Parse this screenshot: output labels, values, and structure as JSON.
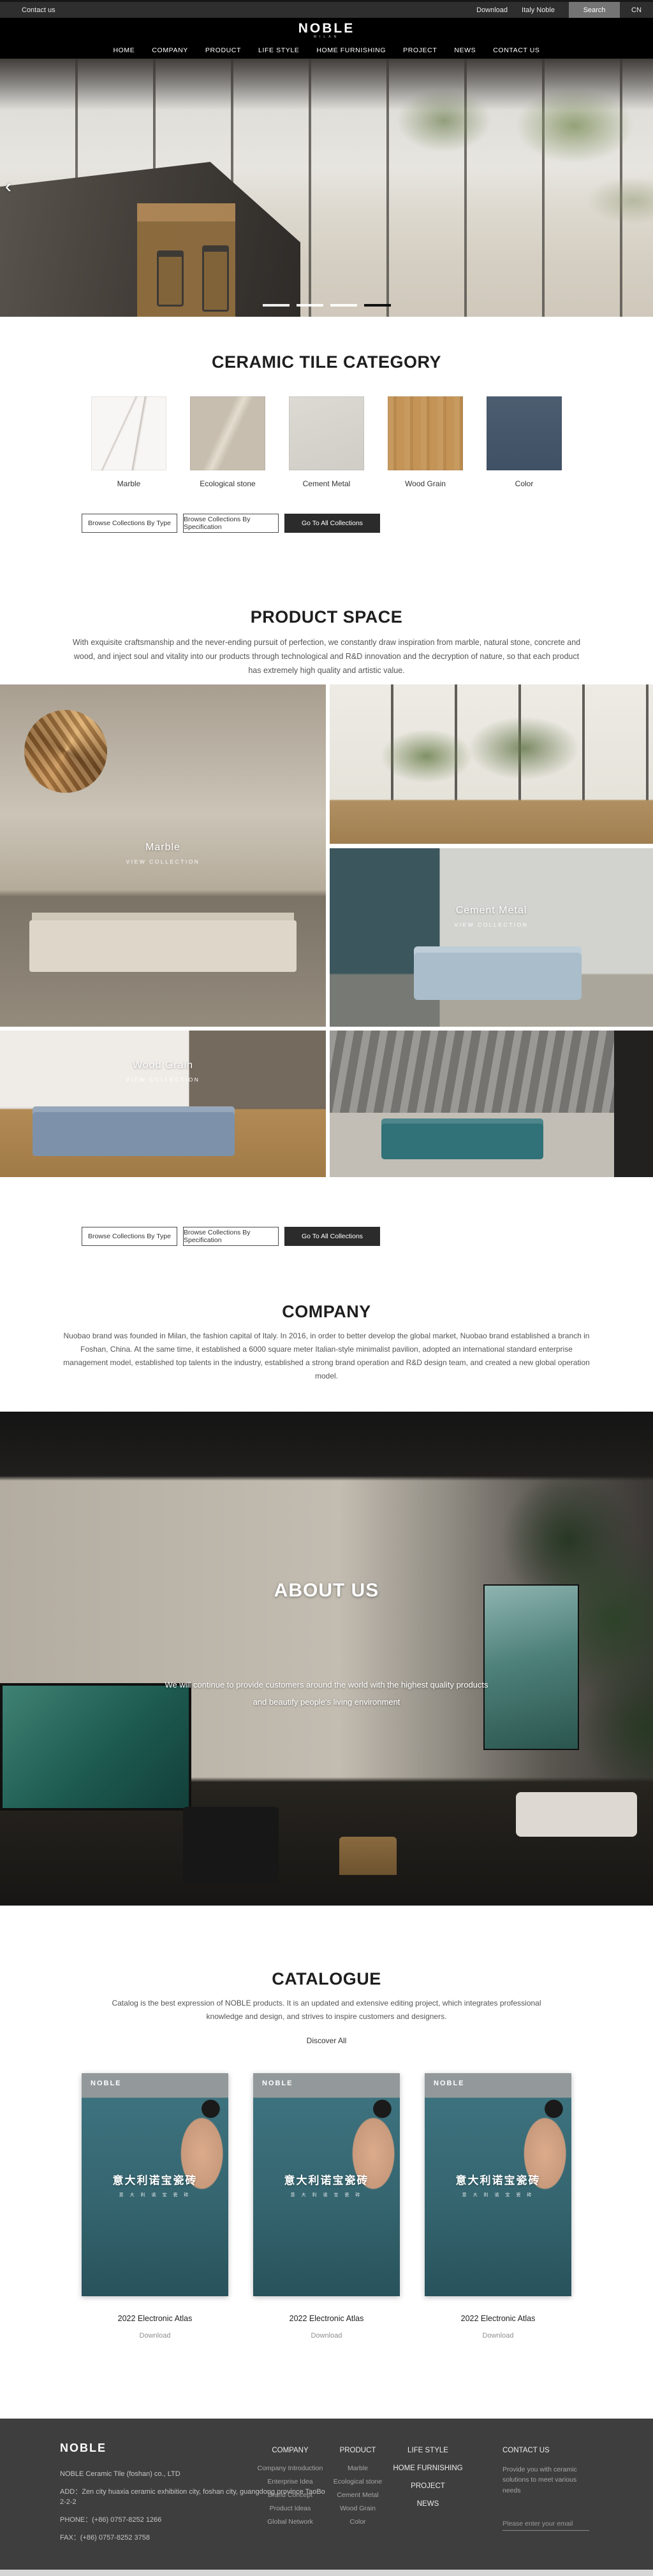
{
  "topbar": {
    "contact": "Contact us",
    "download": "Download",
    "italy_noble": "Italy Noble",
    "search": "Search",
    "lang": "CN"
  },
  "header": {
    "logo": "NOBLE",
    "logo_sub": "MILAN",
    "nav": [
      "HOME",
      "COMPANY",
      "PRODUCT",
      "LIFE STYLE",
      "HOME FURNISHING",
      "PROJECT",
      "NEWS",
      "CONTACT US"
    ]
  },
  "hero": {
    "prev_icon": "‹",
    "slides_total": 4,
    "active_slide": 4
  },
  "category": {
    "title": "CERAMIC TILE CATEGORY",
    "items": [
      {
        "label": "Marble",
        "swatch_color": "#f8f6f4"
      },
      {
        "label": "Ecological stone",
        "swatch_color": "#c7beaf"
      },
      {
        "label": "Cement Metal",
        "swatch_color": "#d6d4cd"
      },
      {
        "label": "Wood Grain",
        "swatch_color": "#c0935a"
      },
      {
        "label": "Color",
        "swatch_color": "#48586b"
      }
    ]
  },
  "collection_buttons": {
    "by_type": "Browse Collections By Type",
    "by_spec": "Browse Collections By Specification",
    "go_all": "Go To All Collections"
  },
  "product_space": {
    "title": "PRODUCT SPACE",
    "description": "With exquisite craftsmanship and the never-ending pursuit of perfection, we constantly draw inspiration from marble, natural stone, concrete and wood, and inject soul and vitality into our products through technological and R&D innovation and the decryption of nature, so that each product has extremely high quality and artistic value.",
    "collections": [
      {
        "name": "Marble",
        "cta": "VIEW COLLECTION"
      },
      {
        "name": "Cement Metal",
        "cta": "VIEW COLLECTION"
      },
      {
        "name": "Wood Grain",
        "cta": "VIEW COLLECTION"
      }
    ]
  },
  "company": {
    "title": "COMPANY",
    "description": "Nuobao brand was founded in Milan, the fashion capital of Italy. In 2016, in order to better develop the global market, Nuobao brand established a branch in Foshan, China. At the same time, it established a 6000 square meter Italian-style minimalist pavilion, adopted an international standard enterprise management model, established top talents in the industry, established a strong brand operation and R&D design team, and created a new global operation model."
  },
  "about": {
    "title": "ABOUT US",
    "line1": "We will continue to provide customers around the world with the highest quality products",
    "line2": "and beautify people's living environment"
  },
  "catalogue": {
    "title": "CATALOGUE",
    "description": "Catalog is the best expression of NOBLE products. It is an updated and extensive editing project, which integrates professional knowledge and design, and strives to inspire customers and designers.",
    "discover": "Discover All",
    "cover": {
      "brand": "NOBLE",
      "title_cn": "意大利诺宝瓷砖",
      "subtitle_cn": "意 大 利 诺 宝 瓷 砖"
    },
    "cards": [
      {
        "title": "2022 Electronic Atlas",
        "download": "Download"
      },
      {
        "title": "2022 Electronic Atlas",
        "download": "Download"
      },
      {
        "title": "2022 Electronic Atlas",
        "download": "Download"
      }
    ]
  },
  "footer": {
    "logo": "NOBLE",
    "company_line": "NOBLE Ceramic Tile (foshan) co., LTD",
    "address": "ADD：Zen city huaxia ceramic exhibition city, foshan city, guangdong province TaoBo 2-2-2",
    "phone": "PHONE：(+86) 0757-8252 1266",
    "fax": "FAX：(+86) 0757-8252 3758",
    "columns": {
      "company": {
        "header": "COMPANY",
        "items": [
          "Company Introduction",
          "Enterprise Idea",
          "Brand Concept",
          "Product Ideas",
          "Global Network"
        ]
      },
      "product": {
        "header": "PRODUCT",
        "items": [
          "Marble",
          "Ecological stone",
          "Cement Metal",
          "Wood Grain",
          "Color"
        ]
      },
      "links": [
        "LIFE STYLE",
        "HOME FURNISHING",
        "PROJECT",
        "NEWS"
      ]
    },
    "contact": {
      "header": "CONTACT US",
      "text": "Provide you with ceramic solutions to meet various needs",
      "email_placeholder": "Please enter your email"
    }
  }
}
